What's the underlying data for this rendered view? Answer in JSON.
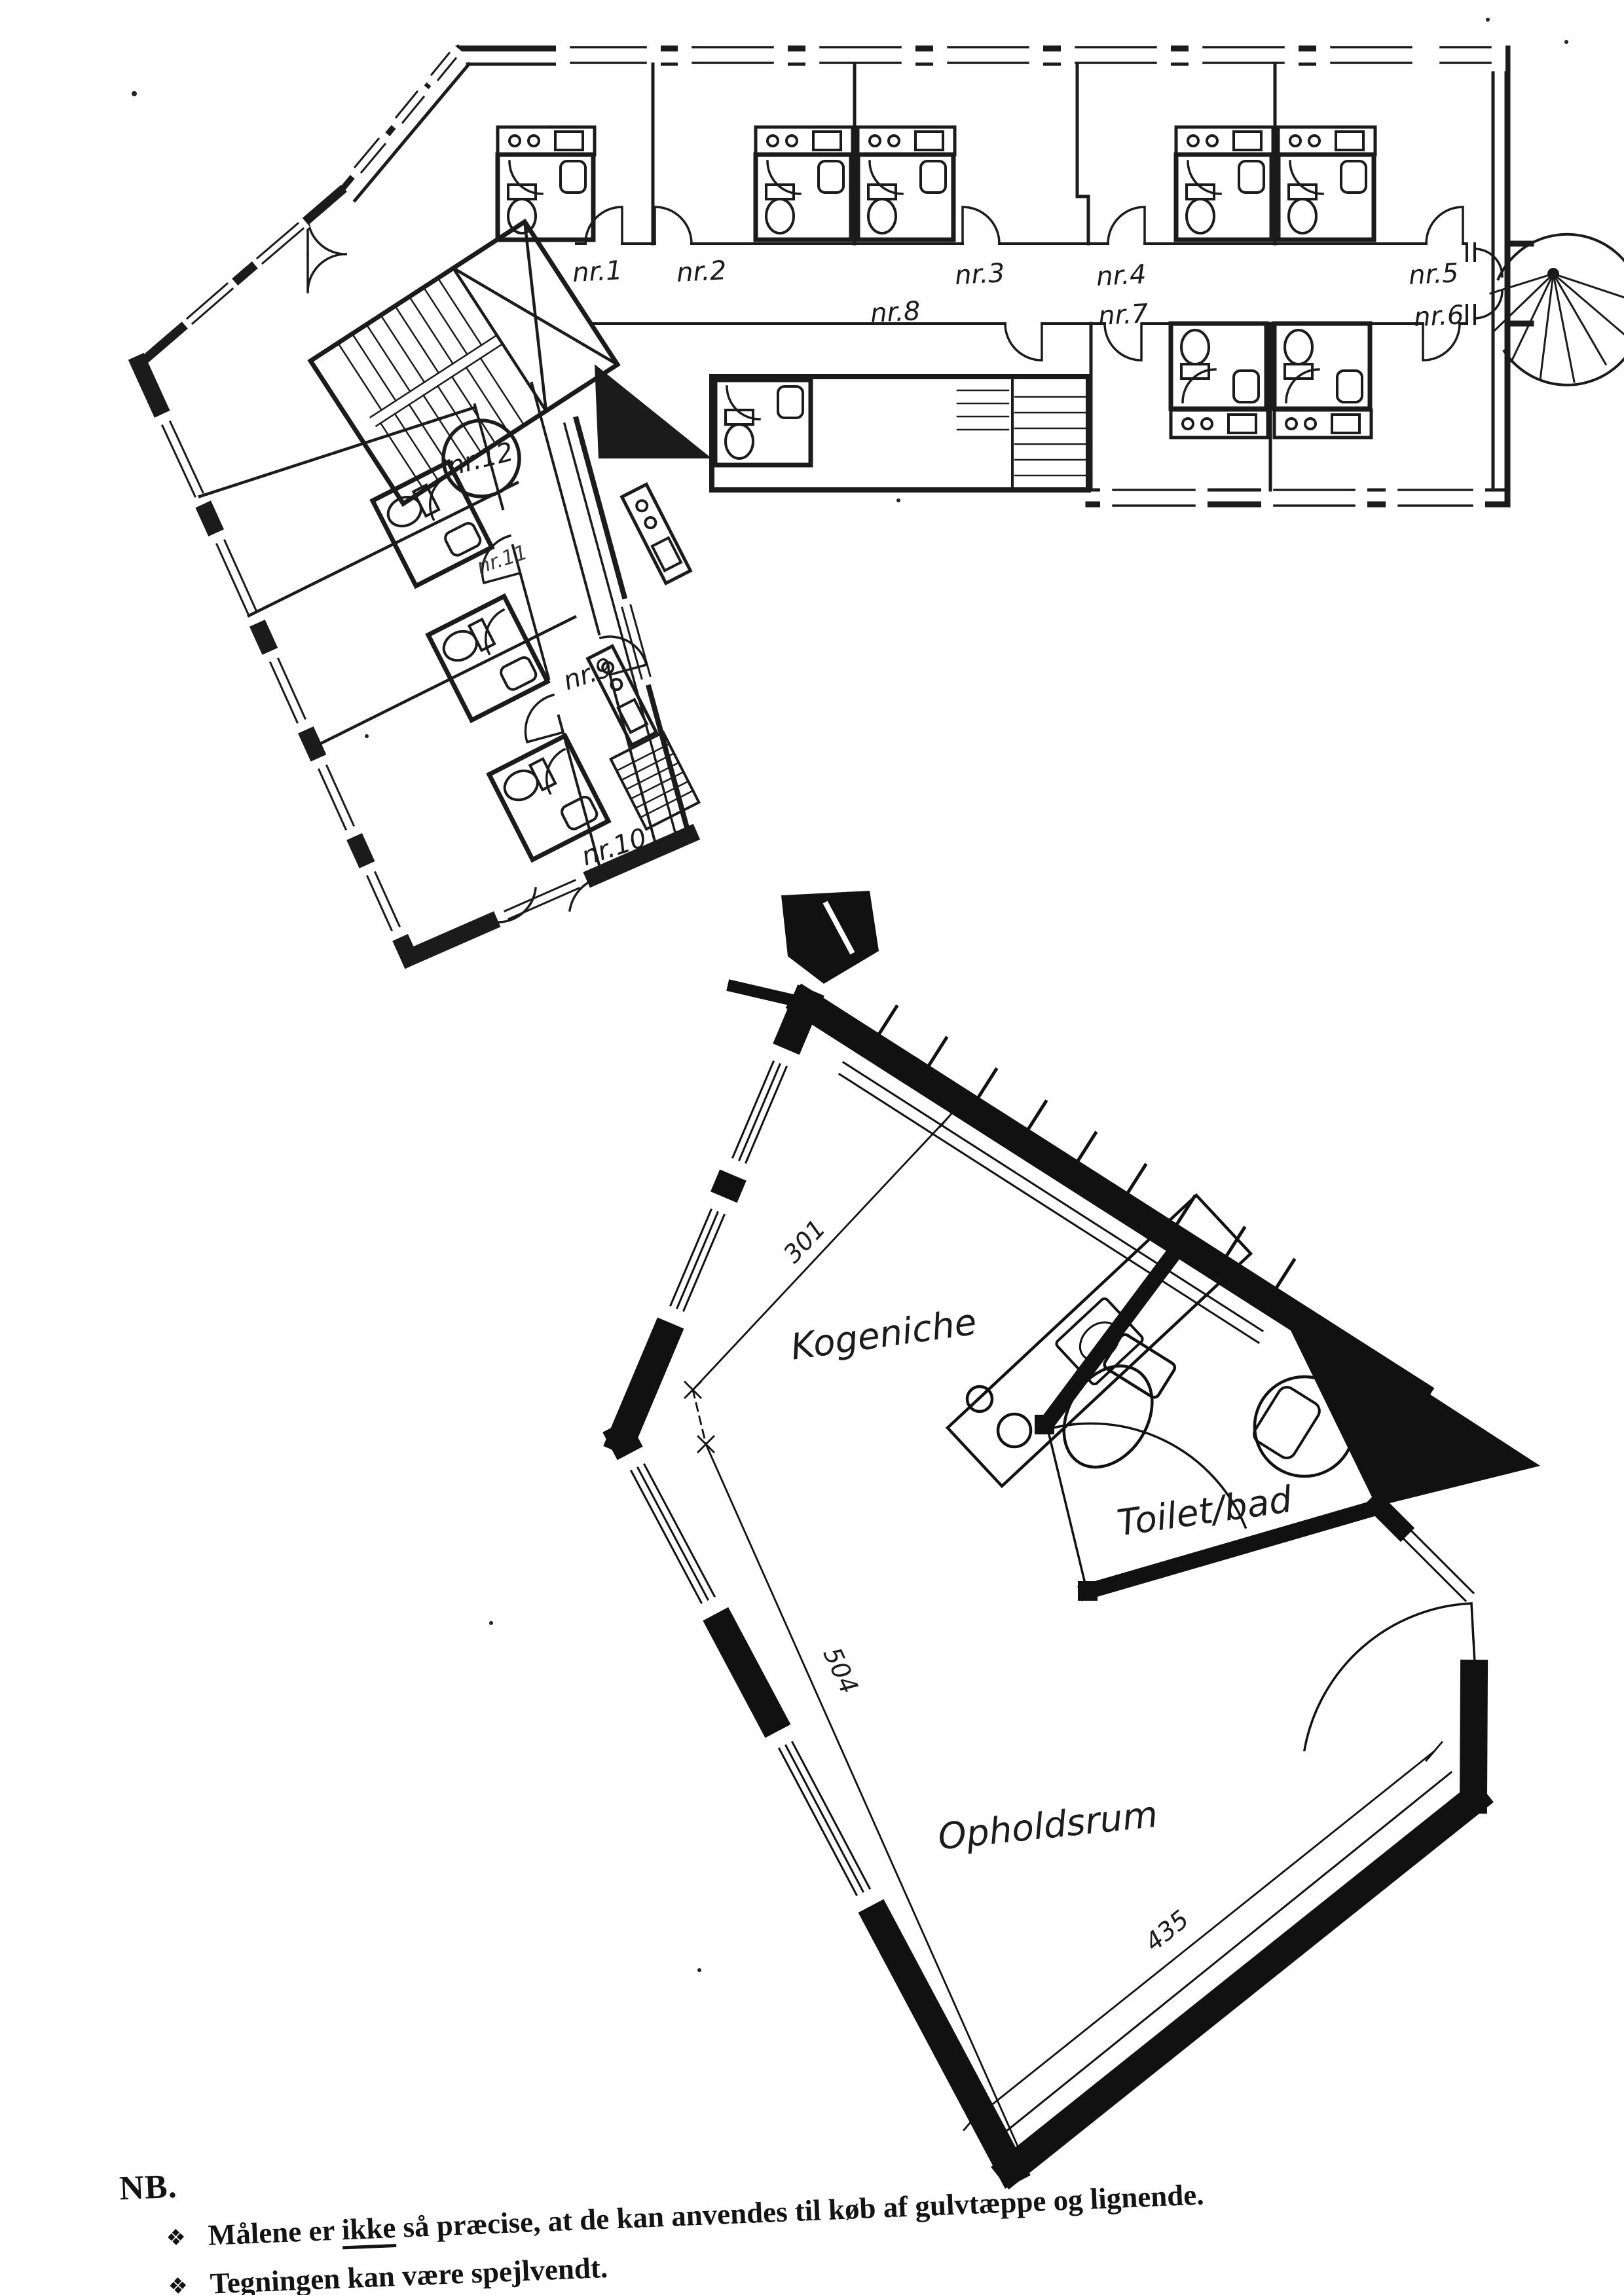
{
  "page": {
    "background": "#ffffff",
    "ink": "#1b1b1b"
  },
  "upper_plan": {
    "corridor_room_labels": [
      "nr.1",
      "nr.2",
      "nr.3",
      "nr.4",
      "nr.5"
    ],
    "lower_room_labels": [
      "nr.8",
      "nr.7",
      "nr.6"
    ],
    "wing_room_labels": [
      "nr.9",
      "nr.10",
      "nr.11"
    ],
    "stair_unit_label": "nr.12"
  },
  "unit_plan": {
    "room_labels": {
      "kitchen": "Kogeniche",
      "bath": "Toilet/bad",
      "living": "Opholdsrum"
    },
    "dimensions": {
      "top_edge": "301",
      "left_edge": "504",
      "bottom_edge": "435"
    }
  },
  "note": {
    "heading": "NB.",
    "bullet_glyph": "❖",
    "items": [
      {
        "before_underline": "Målene er ",
        "underlined": "ikke",
        "after_underline": " så præcise, at de kan anvendes til køb af gulvtæppe og lignende."
      },
      {
        "text": "Tegningen kan være spejlvendt."
      }
    ]
  }
}
